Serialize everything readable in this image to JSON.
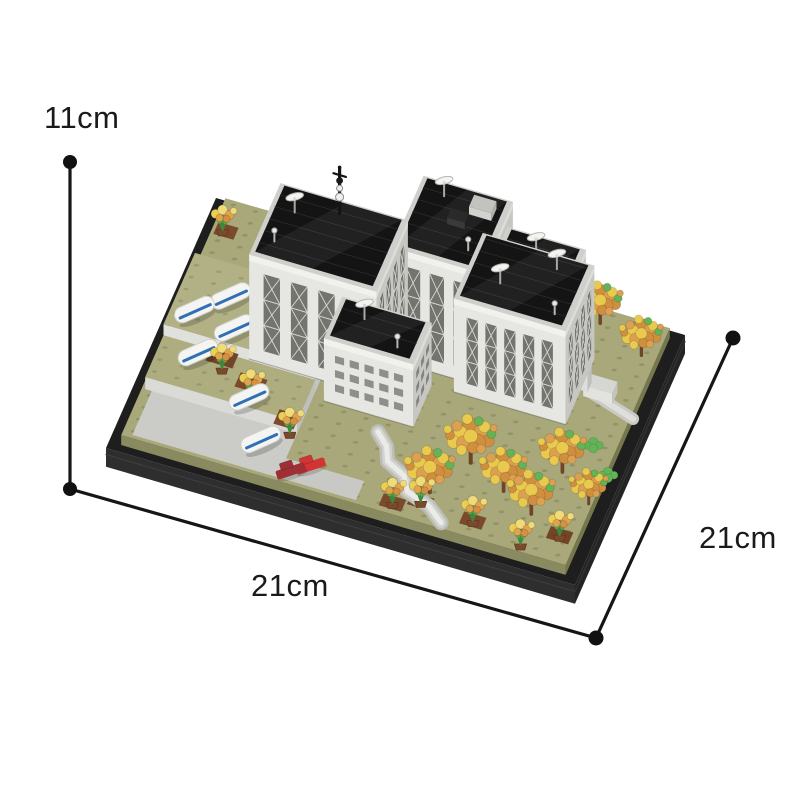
{
  "page": {
    "background_color": "#ffffff"
  },
  "product_view": {
    "alt": "Brick-built model of a white government building with black roofs, satellite dishes, autumn trees, flower beds and parked cars on a black display base"
  },
  "dimensions": {
    "height": {
      "label": "11cm"
    },
    "width": {
      "label": "21cm"
    },
    "depth": {
      "label": "21cm"
    }
  },
  "annotation": {
    "line_color": "#161616",
    "dot_color": "#111111",
    "text_color": "#1a1a1a"
  },
  "model": {
    "colors": {
      "base_black": "#242424",
      "lawn_olive": "#a8a87a",
      "wall_light": "#e6e6e3",
      "wall_shade": "#c6c6c2",
      "roof_black": "#141414",
      "tree_orange": "#d08f3e",
      "tree_yellow": "#e9c94e",
      "leaf_green": "#63b357",
      "car_white": "#f4f4f2",
      "car_stripe_blue": "#2f6fb4",
      "car_red": "#d23434",
      "car_dark_red": "#9e2f35",
      "path_gray": "#d2d2ce",
      "pot_brown": "#7b4a2c",
      "metal_silver": "#b5b5b1"
    }
  }
}
